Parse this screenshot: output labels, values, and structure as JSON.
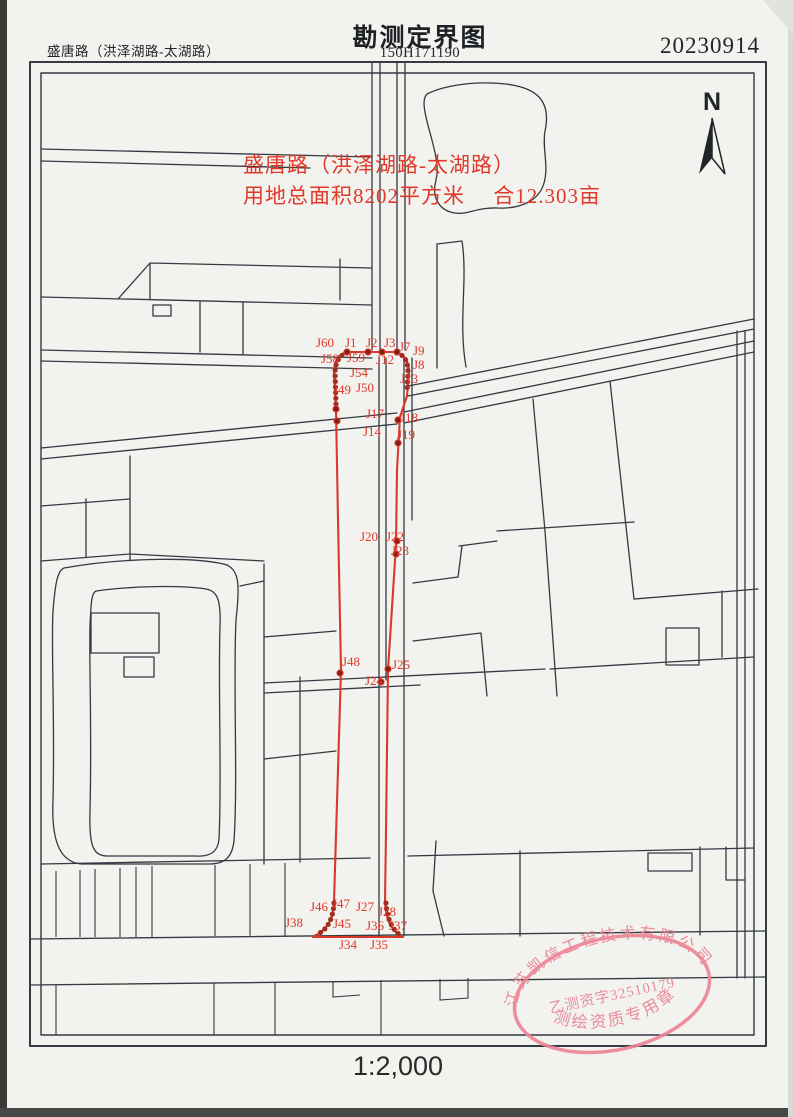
{
  "header": {
    "road_name": "盛唐路（洪泽湖路-太湖路）",
    "title": "勘测定界图",
    "sheet_number": "150H171190",
    "date": "20230914"
  },
  "map": {
    "north_label": "N",
    "annotation_line1": "盛唐路（洪泽湖路-太湖路）",
    "annotation_line2": "用地总面积8202平方米　 合12.303亩",
    "survey_points": [
      {
        "label": "J60",
        "x": 316,
        "y": 335
      },
      {
        "label": "J1",
        "x": 345,
        "y": 335
      },
      {
        "label": "J2",
        "x": 366,
        "y": 335
      },
      {
        "label": "J3",
        "x": 384,
        "y": 335
      },
      {
        "label": "J7",
        "x": 399,
        "y": 339
      },
      {
        "label": "J9",
        "x": 413,
        "y": 343
      },
      {
        "label": "J58",
        "x": 321,
        "y": 351
      },
      {
        "label": "J59",
        "x": 347,
        "y": 350
      },
      {
        "label": "J12",
        "x": 376,
        "y": 352
      },
      {
        "label": "J8",
        "x": 413,
        "y": 357
      },
      {
        "label": "J54",
        "x": 350,
        "y": 365
      },
      {
        "label": "J13",
        "x": 400,
        "y": 371
      },
      {
        "label": "J49",
        "x": 333,
        "y": 382
      },
      {
        "label": "J50",
        "x": 356,
        "y": 380
      },
      {
        "label": "J17",
        "x": 366,
        "y": 406
      },
      {
        "label": "J18",
        "x": 400,
        "y": 410
      },
      {
        "label": "J14",
        "x": 363,
        "y": 424
      },
      {
        "label": "J19",
        "x": 397,
        "y": 427
      },
      {
        "label": "J20",
        "x": 360,
        "y": 529
      },
      {
        "label": "J22",
        "x": 386,
        "y": 529
      },
      {
        "label": "J23",
        "x": 391,
        "y": 543
      },
      {
        "label": "J48",
        "x": 342,
        "y": 654
      },
      {
        "label": "J25",
        "x": 392,
        "y": 657
      },
      {
        "label": "J24",
        "x": 365,
        "y": 673
      },
      {
        "label": "J46",
        "x": 310,
        "y": 899
      },
      {
        "label": "J47",
        "x": 332,
        "y": 896
      },
      {
        "label": "J27",
        "x": 356,
        "y": 899
      },
      {
        "label": "J28",
        "x": 378,
        "y": 904
      },
      {
        "label": "J38",
        "x": 285,
        "y": 915
      },
      {
        "label": "J45",
        "x": 333,
        "y": 916
      },
      {
        "label": "J36",
        "x": 366,
        "y": 918
      },
      {
        "label": "J37",
        "x": 389,
        "y": 918
      },
      {
        "label": "J34",
        "x": 339,
        "y": 937
      },
      {
        "label": "J35",
        "x": 370,
        "y": 937
      }
    ]
  },
  "stamp": {
    "company": "江苏凯信工程技术有限公司",
    "license_no": "乙测资字32510179",
    "caption": "测绘资质专用章"
  },
  "footer": {
    "scale": "1:2,000"
  },
  "colors": {
    "boundary_red": "#d9382a",
    "label_red": "#df382a",
    "line_black": "#333a42",
    "stamp_pink": "#e98092",
    "paper": "#f2f2ef"
  }
}
